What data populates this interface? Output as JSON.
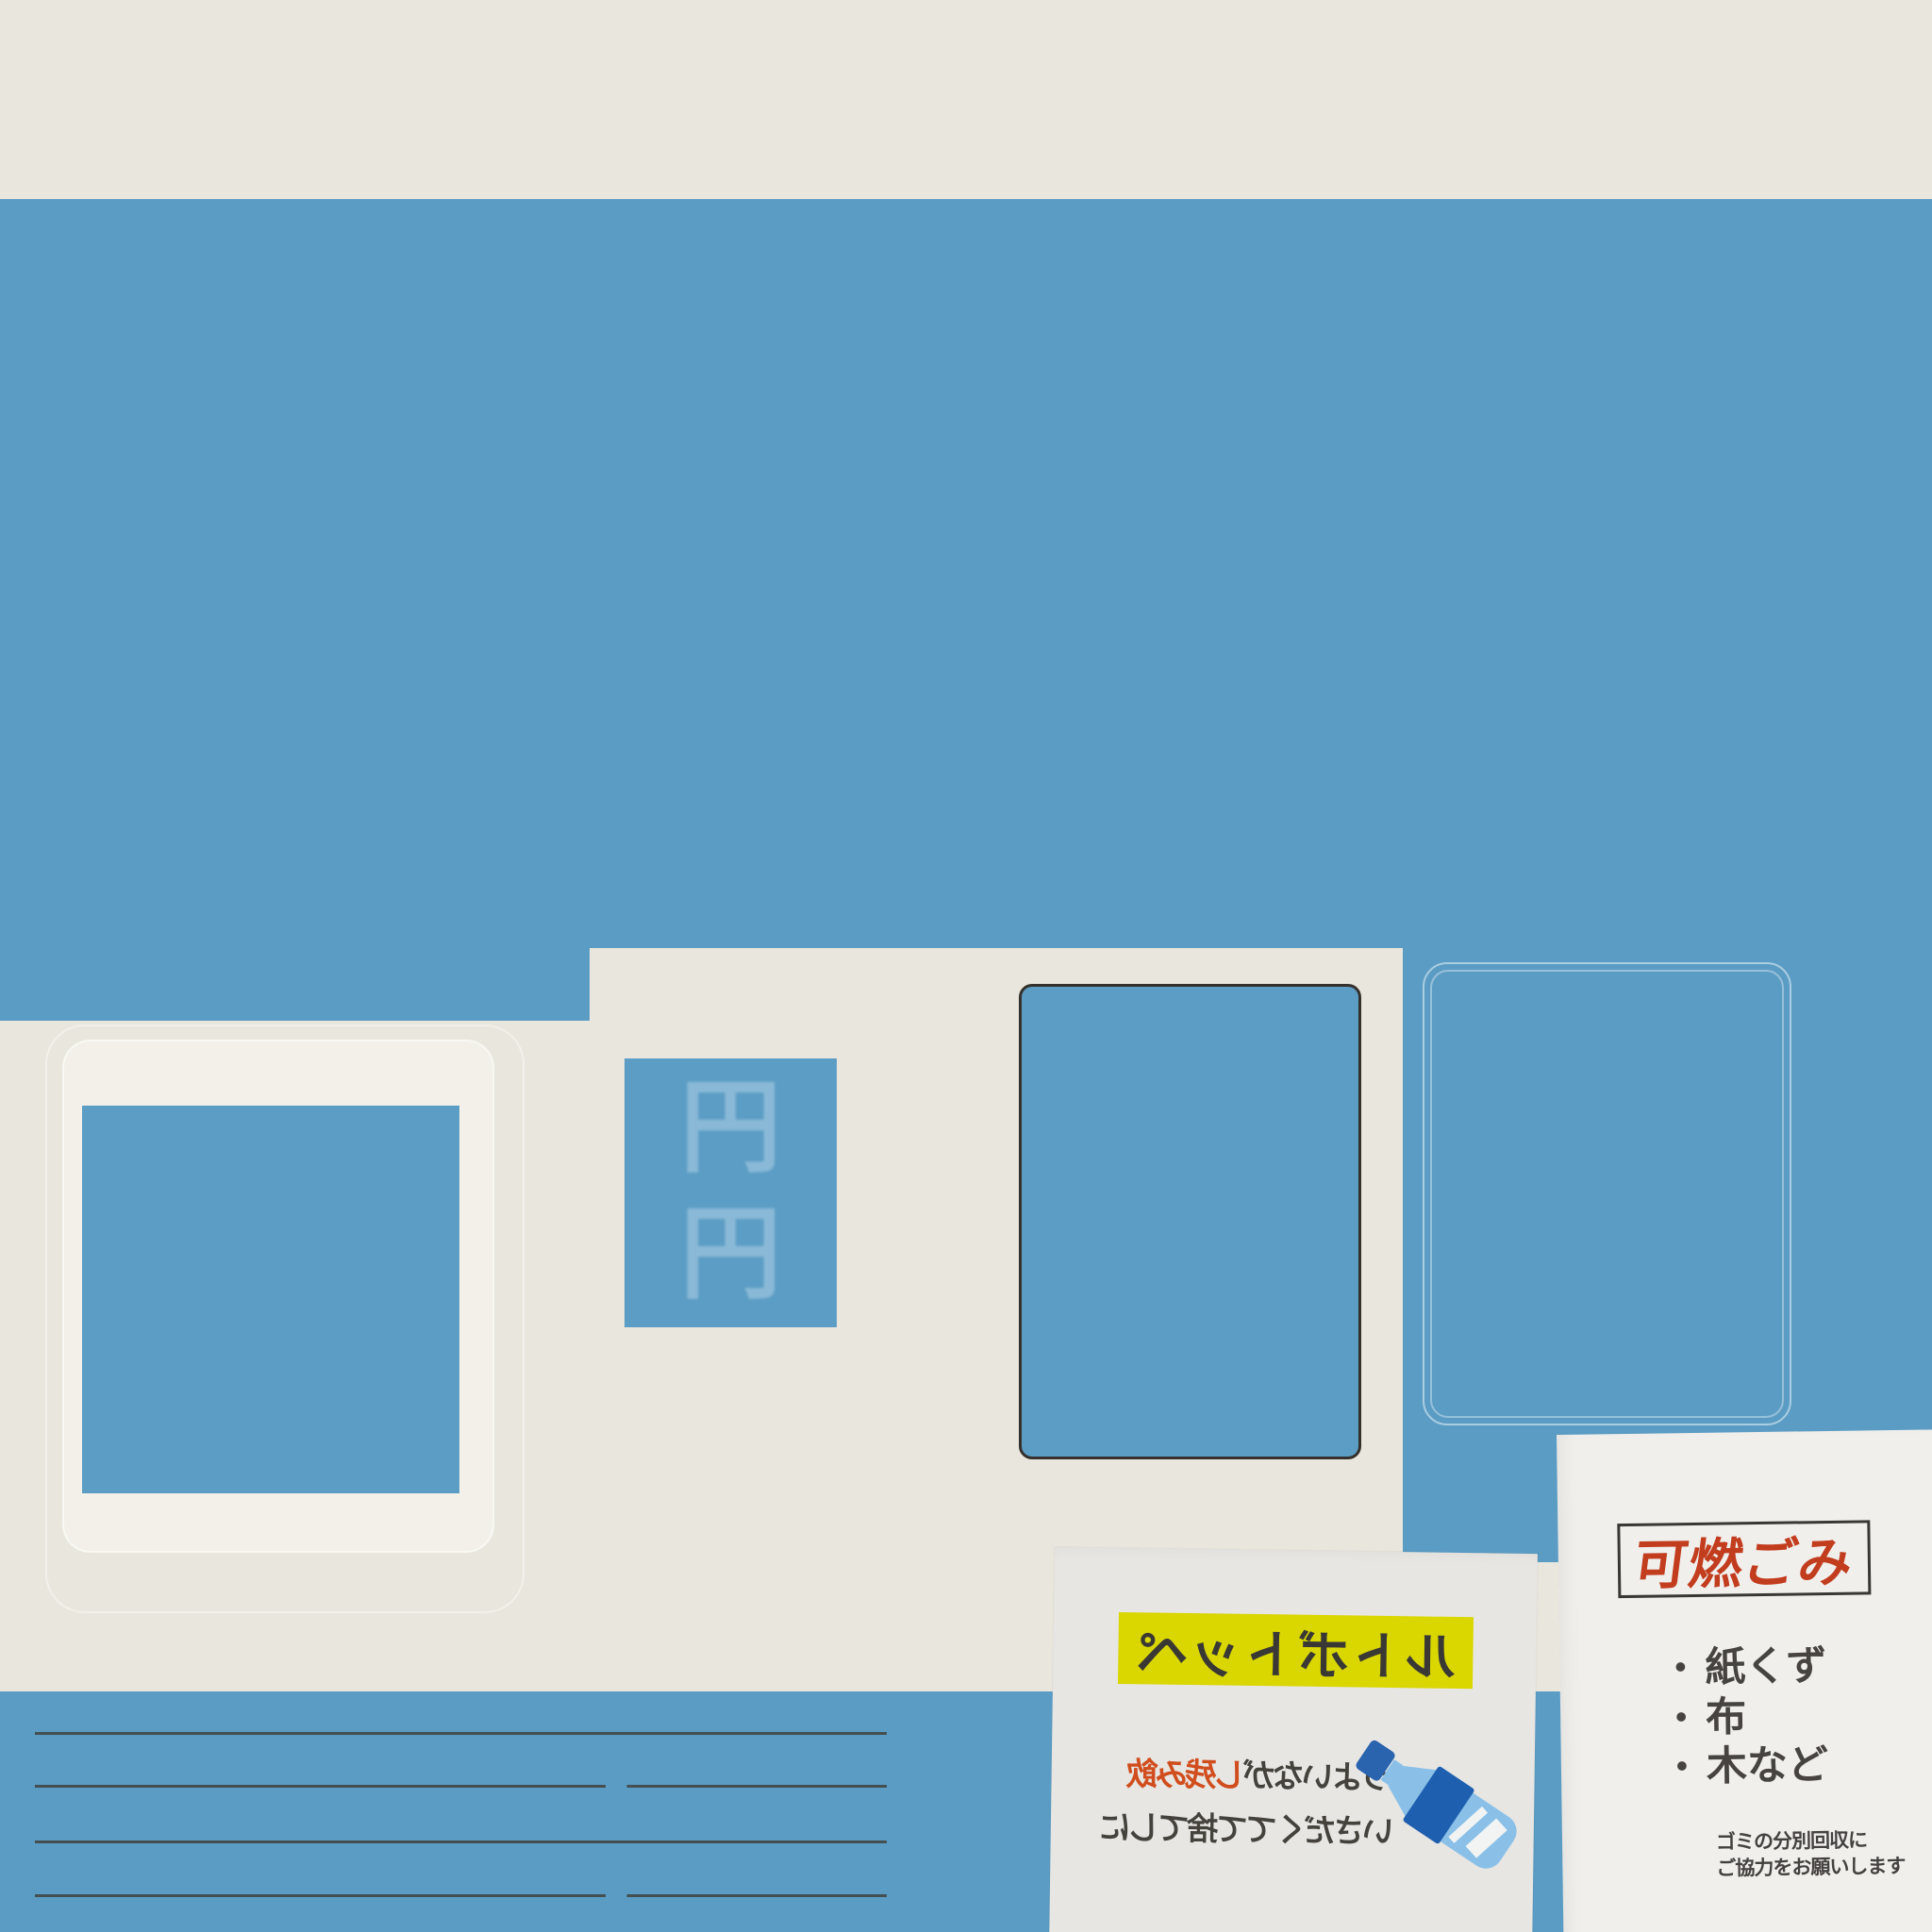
{
  "colors": {
    "wall_blue": "#5b9cc4",
    "background_cream": "#e9e7dd",
    "pet_poster_paper": "#e7e6e3",
    "burnable_poster_paper": "#f0efec",
    "banner_yellow": "#d9d600",
    "note_highlight_orange": "#d14d1d",
    "burnable_title_red": "#c23c1e",
    "ink_dark": "#45423c",
    "frame_dark": "#35302b",
    "chalk_white": "rgba(250,253,255,0.5)",
    "bottle_light_blue": "#8ac0e8",
    "bottle_label_blue": "#1f5fb0",
    "bottle_cap_blue": "#2a63ae"
  },
  "icons": {
    "pet_bottle_icon": "css-shape (tilted PET bottle: cap, shoulder, dark label band, striped body)",
    "faded_yen_marks_icon": "faint chalk-like characters on blue panel"
  },
  "wall": {
    "faded_marks": "円円"
  },
  "pet_poster": {
    "banner_label": "ペットボトル",
    "note_line1_highlight": "飲み残し",
    "note_line1_rest": "がないよう",
    "note_line2": "にして捨ててください"
  },
  "burnable_poster": {
    "title": "可燃ごみ",
    "bullet": "・",
    "items": [
      "紙くず",
      "布",
      "木など"
    ],
    "footer_line1": "ゴミの分別回収に",
    "footer_line2": "ご協力をお願いします"
  }
}
